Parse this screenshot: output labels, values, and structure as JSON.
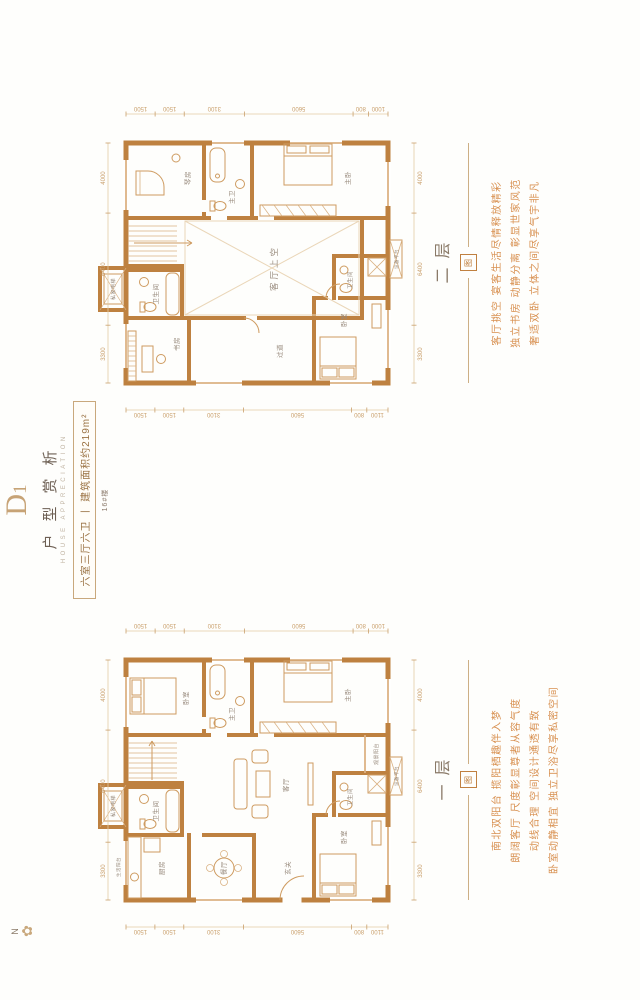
{
  "header": {
    "code_main": "D",
    "code_sub": "1",
    "title": "户型赏析",
    "title_en": "HOUSE APPRECIATION",
    "spec": "六室三厅六卫 丨 建筑面积约219m²",
    "building": "16#楼"
  },
  "compass": {
    "label": "N",
    "rose_icon": "✿"
  },
  "colors": {
    "wall": "#be8140",
    "wall_light": "#dcb284",
    "furniture": "#ce9b60",
    "dimension_text": "#c99f6b",
    "room_text": "#97897b",
    "slogan": "#d89050",
    "heading": "#6e6054",
    "gold_accent": "#c9a87c"
  },
  "floors": [
    {
      "label": "一层",
      "seal": "图",
      "slogans": [
        "南北双阳台 揽阳栖趣伴入梦",
        "朗阔客厅 尺度彰显尊者从容气度",
        "动线合理 空间设计通透有致",
        "卧室动静相宜 独立卫浴尽享私密空间"
      ],
      "dimensions": {
        "top": [
          3300,
          6400,
          4000
        ],
        "bottom": [
          3300,
          6400,
          4000
        ],
        "left": [
          1500,
          1500,
          3100,
          5600,
          800,
          1100
        ],
        "right": [
          1500,
          1500,
          3100,
          5600,
          800,
          1000
        ]
      },
      "rooms": [
        {
          "t": "私家电梯",
          "x": 139,
          "y": 31,
          "s": 5
        },
        {
          "t": "生活阳台",
          "x": 78,
          "y": 36,
          "s": 4.5
        },
        {
          "t": "厨房",
          "x": 77,
          "y": 80
        },
        {
          "t": "卫生间",
          "x": 134,
          "y": 74
        },
        {
          "t": "卧室",
          "x": 247,
          "y": 104
        },
        {
          "t": "主卫",
          "x": 231,
          "y": 150
        },
        {
          "t": "主卧",
          "x": 250,
          "y": 266
        },
        {
          "t": "餐厅",
          "x": 77,
          "y": 142
        },
        {
          "t": "客厅",
          "x": 160,
          "y": 204
        },
        {
          "t": "玄关",
          "x": 77,
          "y": 206
        },
        {
          "t": "卧室",
          "x": 108,
          "y": 262
        },
        {
          "t": "卫生间",
          "x": 148,
          "y": 268,
          "s": 5.5
        },
        {
          "t": "观景阳台",
          "x": 191,
          "y": 294,
          "s": 5
        },
        {
          "t": "设备平台",
          "x": 169,
          "y": 314,
          "s": 4.5
        }
      ]
    },
    {
      "label": "二层",
      "seal": "图",
      "slogans": [
        "客厅挑空 宴客生活尽情释放精彩",
        "独立书房 动静分离 彰显世家风范",
        "奢适双卧 立体之间尽享气宇非凡"
      ],
      "dimensions": {
        "top": [
          3300,
          6400,
          4000
        ],
        "bottom": [
          3300,
          6400,
          4000
        ],
        "left": [
          1500,
          1500,
          3100,
          5600,
          800,
          1100
        ],
        "right": [
          1500,
          1500,
          3100,
          5600,
          800,
          1000
        ]
      },
      "rooms": [
        {
          "t": "私家电梯",
          "x": 139,
          "y": 31,
          "s": 5
        },
        {
          "t": "书房",
          "x": 84,
          "y": 95
        },
        {
          "t": "卫生间",
          "x": 134,
          "y": 74
        },
        {
          "t": "琴房",
          "x": 250,
          "y": 106
        },
        {
          "t": "主卫",
          "x": 231,
          "y": 150
        },
        {
          "t": "主卧",
          "x": 250,
          "y": 266
        },
        {
          "t": "客厅上空",
          "x": 160,
          "y": 193,
          "s": 8.5,
          "ls": 3
        },
        {
          "t": "过道",
          "x": 77,
          "y": 198
        },
        {
          "t": "卧室",
          "x": 108,
          "y": 262
        },
        {
          "t": "卫生间",
          "x": 148,
          "y": 268,
          "s": 5.5
        },
        {
          "t": "设备平台",
          "x": 169,
          "y": 314,
          "s": 4.5
        }
      ]
    }
  ]
}
